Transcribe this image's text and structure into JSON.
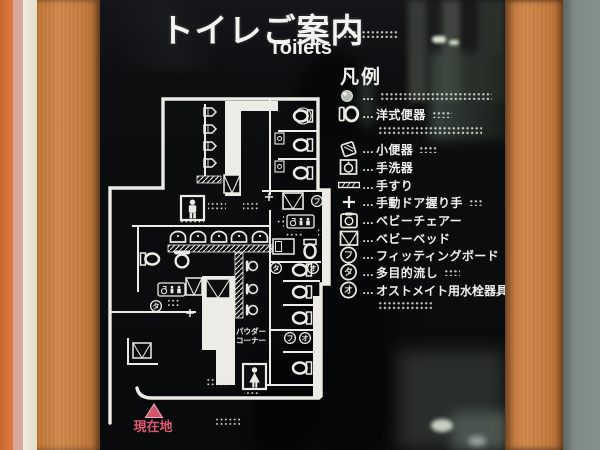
{
  "sign": {
    "title": "トイレご案内",
    "subtitle": "Toilets",
    "legend": {
      "heading": "凡例",
      "ellipsis": "…",
      "items": [
        {
          "icon": "dot-icon",
          "label": ""
        },
        {
          "icon": "western-toilet-icon",
          "label": "洋式便器"
        },
        {
          "icon": "urinal-icon",
          "label": "小便器"
        },
        {
          "icon": "hand-basin-icon",
          "label": "手洗器"
        },
        {
          "icon": "handrail-icon",
          "label": "手すり"
        },
        {
          "icon": "manual-door-handle-icon",
          "label": "手動ドア握り手"
        },
        {
          "icon": "baby-chair-icon",
          "label": "ベビーチェアー"
        },
        {
          "icon": "baby-bed-icon",
          "label": "ベビーベッド"
        },
        {
          "icon": "circle-fu-icon",
          "label": "フィッティングボード",
          "badge": "フ"
        },
        {
          "icon": "circle-ta-icon",
          "label": "多目的流し",
          "badge": "タ"
        },
        {
          "icon": "circle-o-icon",
          "label": "オストメイト用水栓器具",
          "badge": "オ"
        }
      ]
    },
    "map": {
      "powder_corner": {
        "line1": "パウダー",
        "line2": "コーナー"
      },
      "current_location": "現在地",
      "badges": {
        "fu": "フ",
        "ta": "タ",
        "o": "オ"
      }
    },
    "palette": {
      "sign_background": "#0d0e10",
      "line_white": "#ecebe5",
      "frame_wood": "#c9824a",
      "wall_gray": "#7e8a85",
      "marker_red": "#d5566b"
    }
  }
}
